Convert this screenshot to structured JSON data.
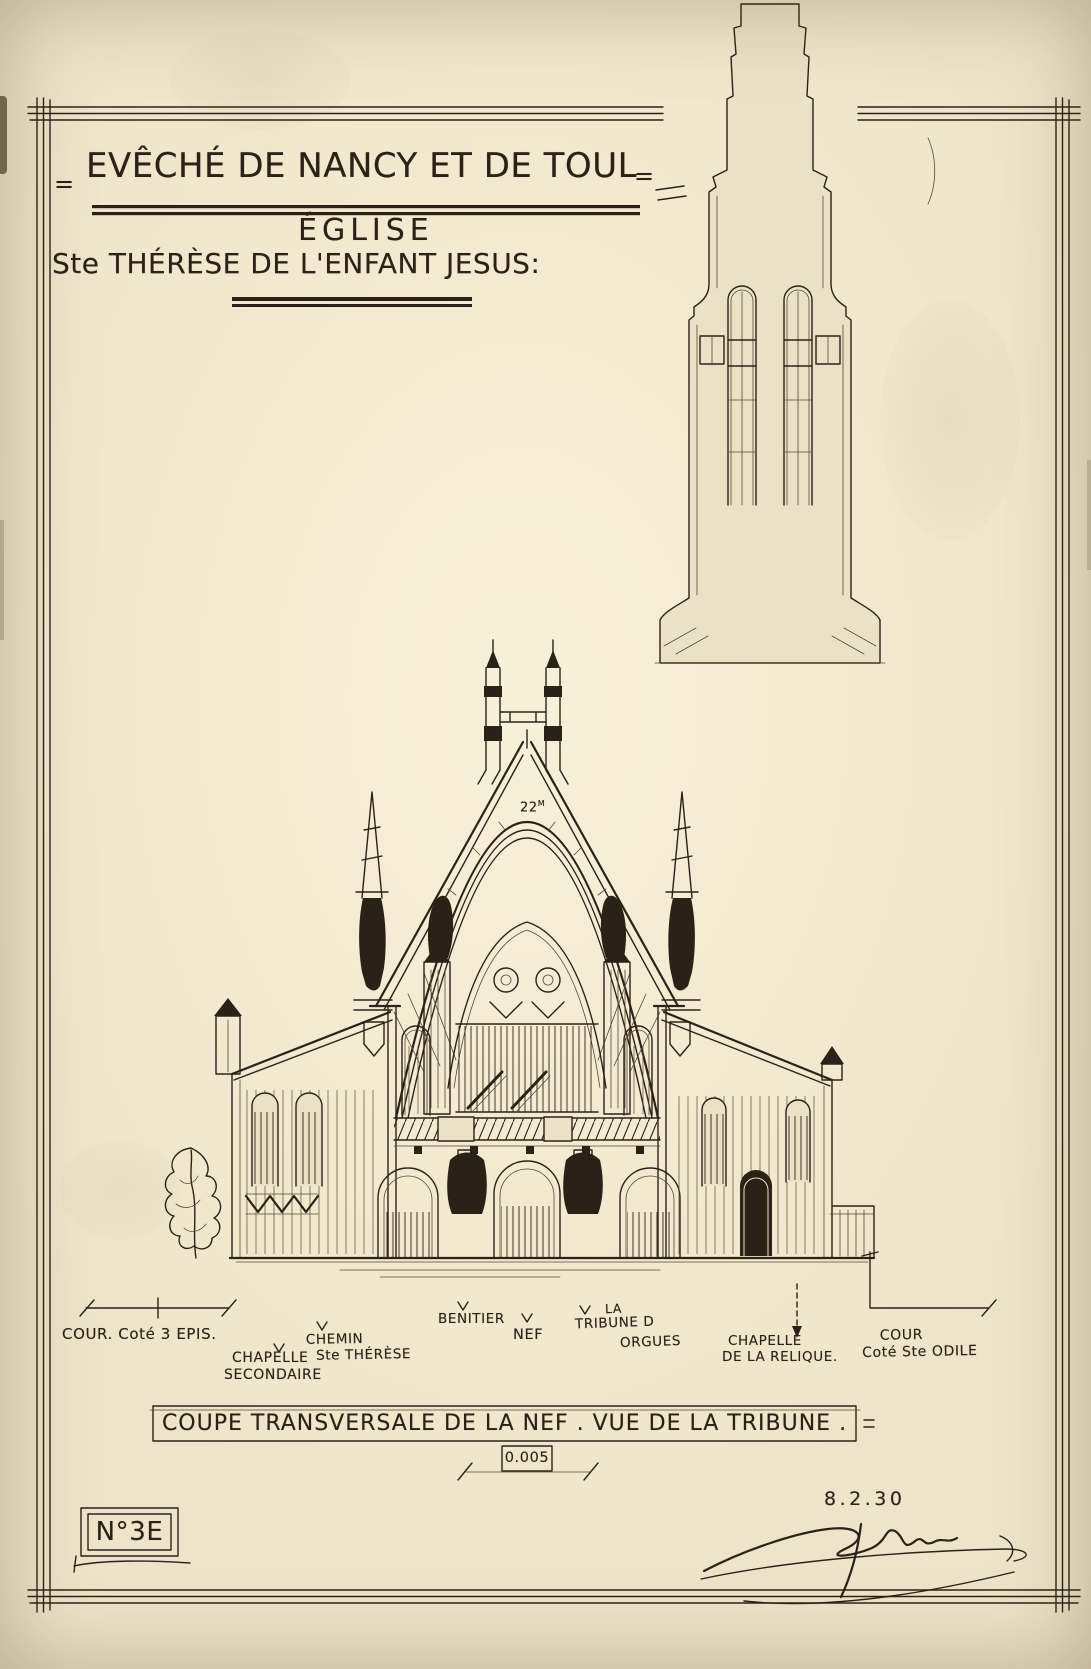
{
  "sheet": {
    "colors": {
      "paper": "#ebe1c6",
      "ink": "#2b2217"
    },
    "header": {
      "mark_left": "=",
      "title": "EVÊCHÉ DE NANCY ET DE TOUL",
      "mark_right": "=",
      "line2": "ÉGLISE",
      "line3": "Ste THÉRÈSE DE L'ENFANT JESUS:"
    },
    "annotations": {
      "height_value": "22",
      "height_unit": "M"
    },
    "labels": {
      "cour_3epis": "COUR. Coté 3 EPIS.",
      "chapelle_secondaire_1": "CHAPELLE",
      "chapelle_secondaire_2": "SECONDAIRE",
      "chemin_1": "CHEMIN",
      "chemin_2": "Ste THÉRÈSE",
      "benitier": "BENITIER",
      "nef": "NEF",
      "tribune_1": "LA",
      "tribune_2": "TRIBUNE D",
      "tribune_3": "ORGUES",
      "relique_1": "CHAPELLE",
      "relique_2": "DE LA RELIQUE.",
      "cour_odile_1": "COUR",
      "cour_odile_2": "Coté Ste ODILE"
    },
    "footer": {
      "caption": "COUPE TRANSVERSALE DE LA NEF . VUE DE LA TRIBUNE .",
      "scale": "0.005",
      "sheet_number": "N°3E",
      "date": "8.2.30"
    }
  }
}
